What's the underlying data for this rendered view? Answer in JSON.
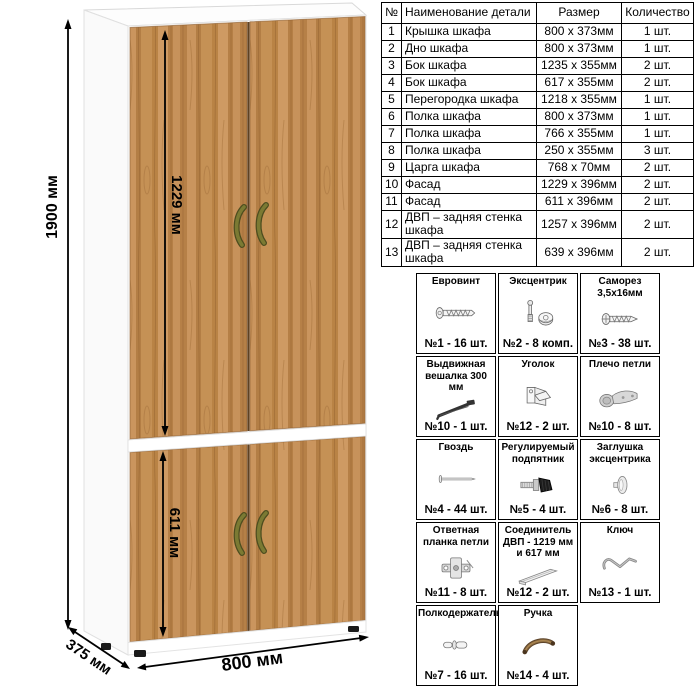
{
  "wardrobe": {
    "dimensions": {
      "height": "1900 мм",
      "upper_door": "1229 мм",
      "lower_door": "611 мм",
      "depth": "375 мм",
      "width": "800 мм"
    },
    "colors": {
      "wood_base": "#c18a52",
      "wood_dark": "#a5703a",
      "wood_light": "#d4a46b",
      "carcass": "#ffffff",
      "handle": "#7b7a33",
      "dimension_lines": "#000000"
    }
  },
  "parts_table": {
    "columns": [
      "№",
      "Наименование детали",
      "Размер",
      "Количество"
    ],
    "rows": [
      [
        "1",
        "Крышка шкафа",
        "800 x 373мм",
        "1 шт."
      ],
      [
        "2",
        "Дно шкафа",
        "800 x 373мм",
        "1 шт."
      ],
      [
        "3",
        "Бок шкафа",
        "1235 x 355мм",
        "2 шт."
      ],
      [
        "4",
        "Бок шкафа",
        "617 x 355мм",
        "2 шт."
      ],
      [
        "5",
        "Перегородка шкафа",
        "1218 x 355мм",
        "1 шт."
      ],
      [
        "6",
        "Полка шкафа",
        "800 x 373мм",
        "1 шт."
      ],
      [
        "7",
        "Полка шкафа",
        "766 x 355мм",
        "1 шт."
      ],
      [
        "8",
        "Полка шкафа",
        "250 x 355мм",
        "3 шт."
      ],
      [
        "9",
        "Царга шкафа",
        "768 x 70мм",
        "2 шт."
      ],
      [
        "10",
        "Фасад",
        "1229 x 396мм",
        "2 шт."
      ],
      [
        "11",
        "Фасад",
        "611 x 396мм",
        "2 шт."
      ],
      [
        "12",
        "ДВП – задняя стенка шкафа",
        "1257 x 396мм",
        "2 шт."
      ],
      [
        "13",
        "ДВП – задняя стенка шкафа",
        "639 x 396мм",
        "2 шт."
      ]
    ]
  },
  "hardware": {
    "items": [
      {
        "title": "Евровинт",
        "qty": "№1 - 16 шт.",
        "icon": "euro-screw-icon"
      },
      {
        "title": "Эксцентрик",
        "qty": "№2 - 8 комп.",
        "icon": "cam-lock-icon"
      },
      {
        "title": "Саморез 3,5х16мм",
        "qty": "№3 - 38 шт.",
        "icon": "self-tapping-screw-icon"
      },
      {
        "title": "Выдвижная вешалка 300 мм",
        "qty": "№10 - 1 шт.",
        "icon": "pullout-hanger-icon"
      },
      {
        "title": "Уголок",
        "qty": "№12 - 2 шт.",
        "icon": "corner-bracket-icon"
      },
      {
        "title": "Плечо петли",
        "qty": "№10 - 8 шт.",
        "icon": "hinge-arm-icon"
      },
      {
        "title": "Гвоздь",
        "qty": "№4 - 44 шт.",
        "icon": "nail-icon"
      },
      {
        "title": "Регулируемый подпятник",
        "qty": "№5 - 4 шт.",
        "icon": "adjustable-foot-icon"
      },
      {
        "title": "Заглушка эксцентрика",
        "qty": "№6 - 8 шт.",
        "icon": "cam-cap-icon"
      },
      {
        "title": "Ответная планка петли",
        "qty": "№11 - 8 шт.",
        "icon": "hinge-plate-icon"
      },
      {
        "title": "Соединитель ДВП - 1219 мм и 617 мм",
        "qty": "№12 - 2 шт.",
        "icon": "hdf-connector-icon"
      },
      {
        "title": "Ключ",
        "qty": "№13 - 1 шт.",
        "icon": "hex-key-icon"
      },
      {
        "title": "Полкодержатель",
        "qty": "№7 - 16 шт.",
        "icon": "shelf-pin-icon"
      },
      {
        "title": "Ручка",
        "qty": "№14 - 4 шт.",
        "icon": "handle-icon"
      }
    ]
  }
}
